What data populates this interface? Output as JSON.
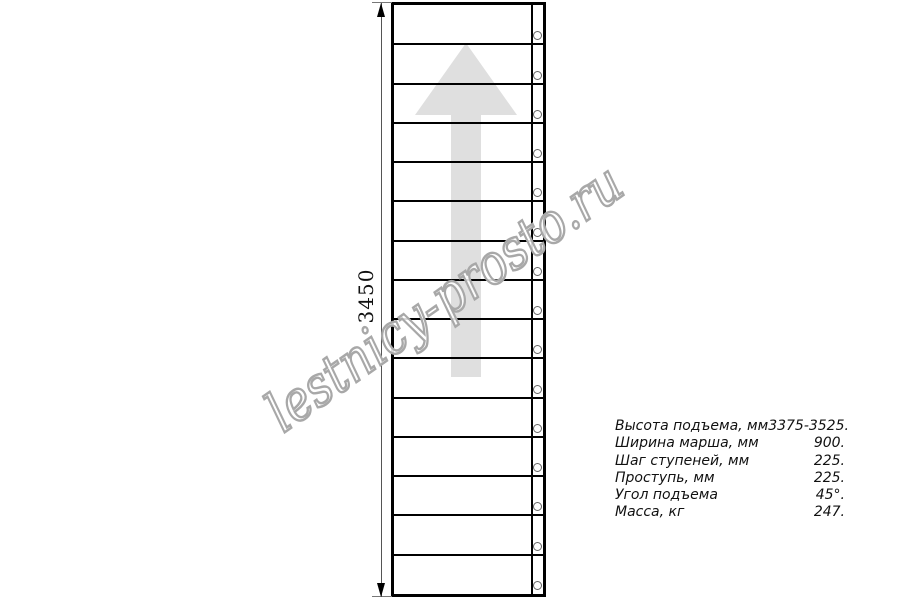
{
  "page": {
    "background": "#ffffff",
    "kind": "staircase technical drawing, top view"
  },
  "drawing": {
    "dimension": {
      "label": "3450"
    },
    "staircase": {
      "step_count": 15,
      "bolt_count": 15
    },
    "direction_arrow": "up-arrow",
    "watermark_text": "lestnicy-prosto.ru"
  },
  "specs": {
    "rows": [
      {
        "label": "Высота подъема, мм",
        "value": "3375-3525."
      },
      {
        "label": "Ширина марша, мм",
        "value": "900."
      },
      {
        "label": "Шаг ступеней, мм",
        "value": "225."
      },
      {
        "label": "Проступь, мм",
        "value": "225."
      },
      {
        "label": "Угол подъема",
        "value": "45°."
      },
      {
        "label": "Масса, кг",
        "value": "247."
      }
    ]
  },
  "colors": {
    "line": "#000000",
    "arrow_fill": "#dfdfdf",
    "watermark_outline": "#a8a8a8",
    "dimension_line": "#555555",
    "text": "#111111"
  }
}
